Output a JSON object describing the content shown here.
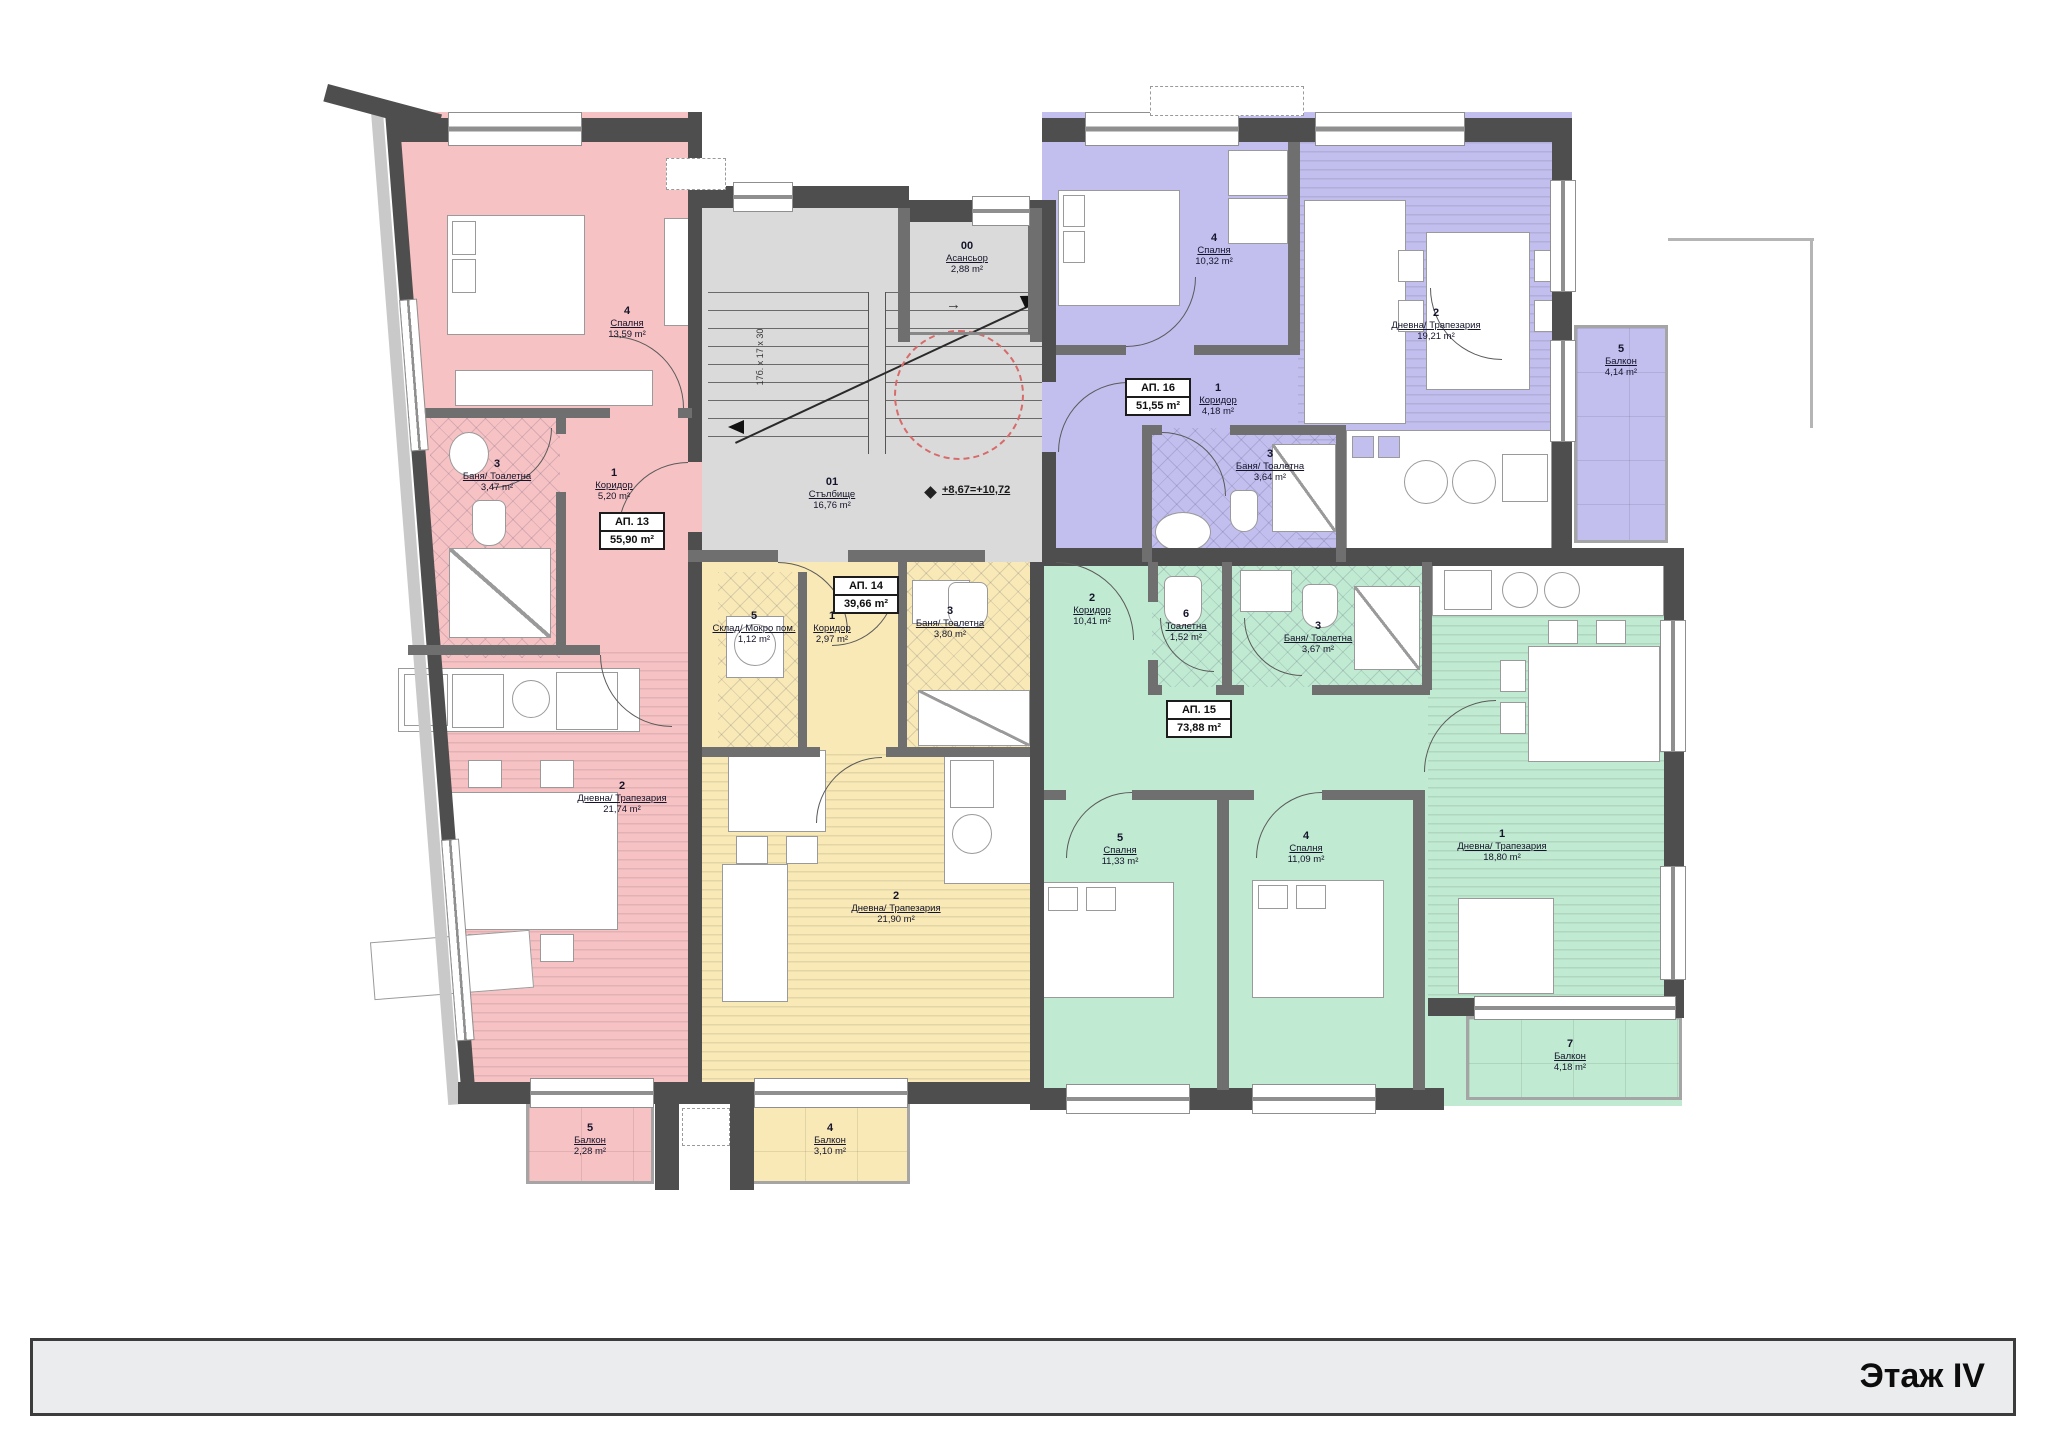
{
  "title_block": {
    "floor_label": "Этаж IV"
  },
  "common_areas": {
    "elevator": {
      "num": "00",
      "name": "Асансьор",
      "area": "2,88 m²"
    },
    "stairwell": {
      "num": "01",
      "name": "Стълбище",
      "area": "16,76 m²"
    },
    "level_mark": "+8,67=+10,72",
    "stair_dimensions": "17б. x 17 x 30"
  },
  "icons": {
    "elevator_arrow": "→"
  },
  "colors": {
    "ap13_pink": "#f7c2c4",
    "ap14_yellow": "#f9e9b6",
    "ap15_green": "#c0ead1",
    "ap16_purple": "#c2beee",
    "core_gray": "#dadada"
  },
  "apartments": [
    {
      "id": "АП. 13",
      "total_area": "55,90 m²",
      "rooms": [
        {
          "num": "4",
          "name": "Спалня",
          "area": "13,59 m²"
        },
        {
          "num": "3",
          "name": "Баня/ Тоалетна",
          "area": "3,47 m²"
        },
        {
          "num": "1",
          "name": "Коридор",
          "area": "5,20 m²"
        },
        {
          "num": "2",
          "name": "Дневна/ Трапезария",
          "area": "21,74 m²"
        },
        {
          "num": "5",
          "name": "Балкон",
          "area": "2,28 m²"
        }
      ]
    },
    {
      "id": "АП. 14",
      "total_area": "39,66 m²",
      "rooms": [
        {
          "num": "5",
          "name": "Склад/ Мокро пом.",
          "area": "1,12 m²"
        },
        {
          "num": "1",
          "name": "Коридор",
          "area": "2,97 m²"
        },
        {
          "num": "3",
          "name": "Баня/ Тоалетна",
          "area": "3,80 m²"
        },
        {
          "num": "2",
          "name": "Дневна/ Трапезария",
          "area": "21,90 m²"
        },
        {
          "num": "4",
          "name": "Балкон",
          "area": "3,10 m²"
        }
      ]
    },
    {
      "id": "АП. 15",
      "total_area": "73,88 m²",
      "rooms": [
        {
          "num": "2",
          "name": "Коридор",
          "area": "10,41 m²"
        },
        {
          "num": "6",
          "name": "Тоалетна",
          "area": "1,52 m²"
        },
        {
          "num": "3",
          "name": "Баня/ Тоалетна",
          "area": "3,67 m²"
        },
        {
          "num": "5",
          "name": "Спалня",
          "area": "11,33 m²"
        },
        {
          "num": "4",
          "name": "Спалня",
          "area": "11,09 m²"
        },
        {
          "num": "1",
          "name": "Дневна/ Трапезария",
          "area": "18,80 m²"
        },
        {
          "num": "7",
          "name": "Балкон",
          "area": "4,18 m²"
        }
      ]
    },
    {
      "id": "АП. 16",
      "total_area": "51,55 m²",
      "rooms": [
        {
          "num": "4",
          "name": "Спалня",
          "area": "10,32 m²"
        },
        {
          "num": "2",
          "name": "Дневна/ Трапезария",
          "area": "19,21 m²"
        },
        {
          "num": "1",
          "name": "Коридор",
          "area": "4,18 m²"
        },
        {
          "num": "3",
          "name": "Баня/ Тоалетна",
          "area": "3,64 m²"
        },
        {
          "num": "5",
          "name": "Балкон",
          "area": "4,14 m²"
        }
      ]
    }
  ]
}
